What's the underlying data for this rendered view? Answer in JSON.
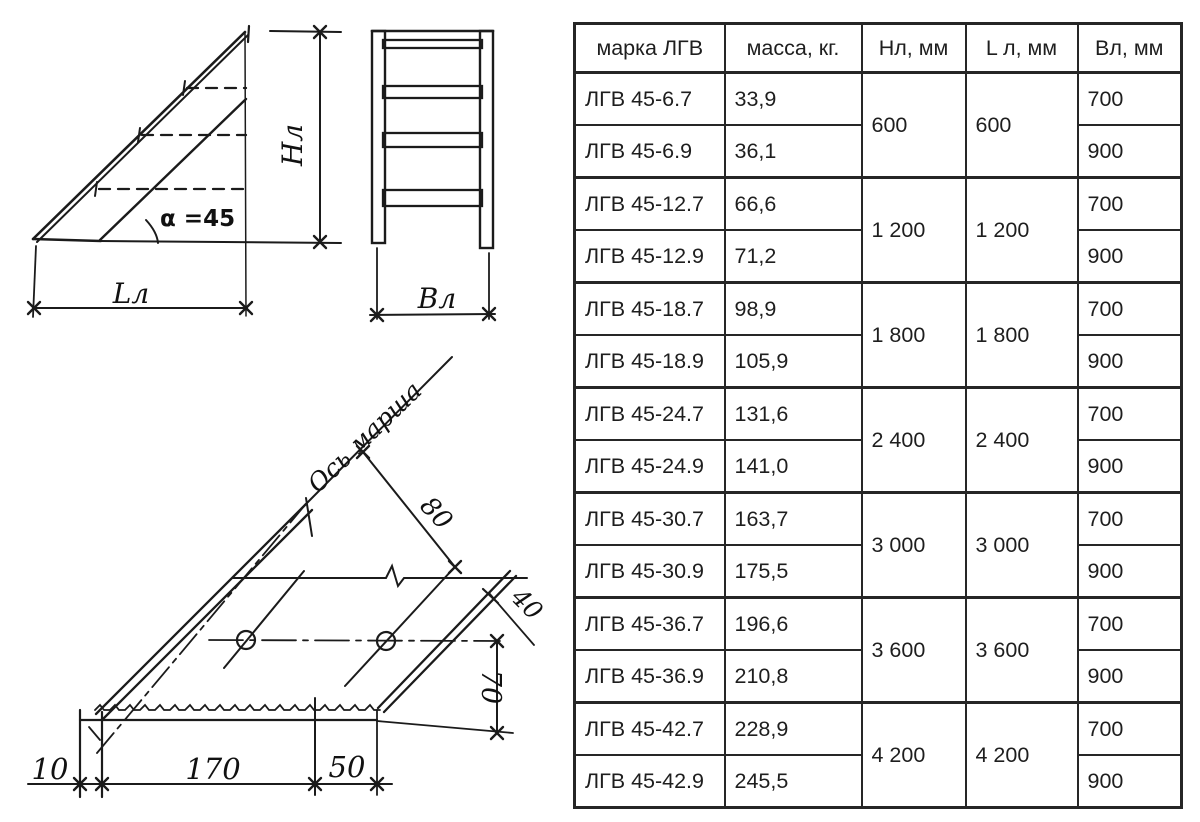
{
  "side_view": {
    "angle": "α =45",
    "height": "Нл",
    "length": "Lл"
  },
  "front_view": {
    "width": "Вл"
  },
  "step_view": {
    "axis": "Ось марша",
    "d80": "80",
    "d40": "40",
    "d70": "70",
    "d10": "10",
    "d170": "170",
    "d50": "50"
  },
  "table": {
    "headers": [
      "марка ЛГВ",
      "масса, кг.",
      "Нл, мм",
      "L л, мм",
      "Вл, мм"
    ],
    "groups": [
      {
        "nl": "600",
        "ll": "600",
        "rows": [
          {
            "mark": "ЛГВ 45-6.7",
            "mass": "33,9",
            "v": "700"
          },
          {
            "mark": "ЛГВ 45-6.9",
            "mass": "36,1",
            "v": "900"
          }
        ]
      },
      {
        "nl": "1 200",
        "ll": "1 200",
        "rows": [
          {
            "mark": "ЛГВ 45-12.7",
            "mass": "66,6",
            "v": "700"
          },
          {
            "mark": "ЛГВ 45-12.9",
            "mass": "71,2",
            "v": "900"
          }
        ]
      },
      {
        "nl": "1 800",
        "ll": "1 800",
        "rows": [
          {
            "mark": "ЛГВ 45-18.7",
            "mass": "98,9",
            "v": "700"
          },
          {
            "mark": "ЛГВ 45-18.9",
            "mass": "105,9",
            "v": "900"
          }
        ]
      },
      {
        "nl": "2 400",
        "ll": "2 400",
        "rows": [
          {
            "mark": "ЛГВ 45-24.7",
            "mass": "131,6",
            "v": "700"
          },
          {
            "mark": "ЛГВ 45-24.9",
            "mass": "141,0",
            "v": "900"
          }
        ]
      },
      {
        "nl": "3 000",
        "ll": "3 000",
        "rows": [
          {
            "mark": "ЛГВ 45-30.7",
            "mass": "163,7",
            "v": "700"
          },
          {
            "mark": "ЛГВ 45-30.9",
            "mass": "175,5",
            "v": "900"
          }
        ]
      },
      {
        "nl": "3 600",
        "ll": "3 600",
        "rows": [
          {
            "mark": "ЛГВ 45-36.7",
            "mass": "196,6",
            "v": "700"
          },
          {
            "mark": "ЛГВ 45-36.9",
            "mass": "210,8",
            "v": "900"
          }
        ]
      },
      {
        "nl": "4 200",
        "ll": "4 200",
        "rows": [
          {
            "mark": "ЛГВ 45-42.7",
            "mass": "228,9",
            "v": "700"
          },
          {
            "mark": "ЛГВ 45-42.9",
            "mass": "245,5",
            "v": "900"
          }
        ]
      }
    ]
  }
}
